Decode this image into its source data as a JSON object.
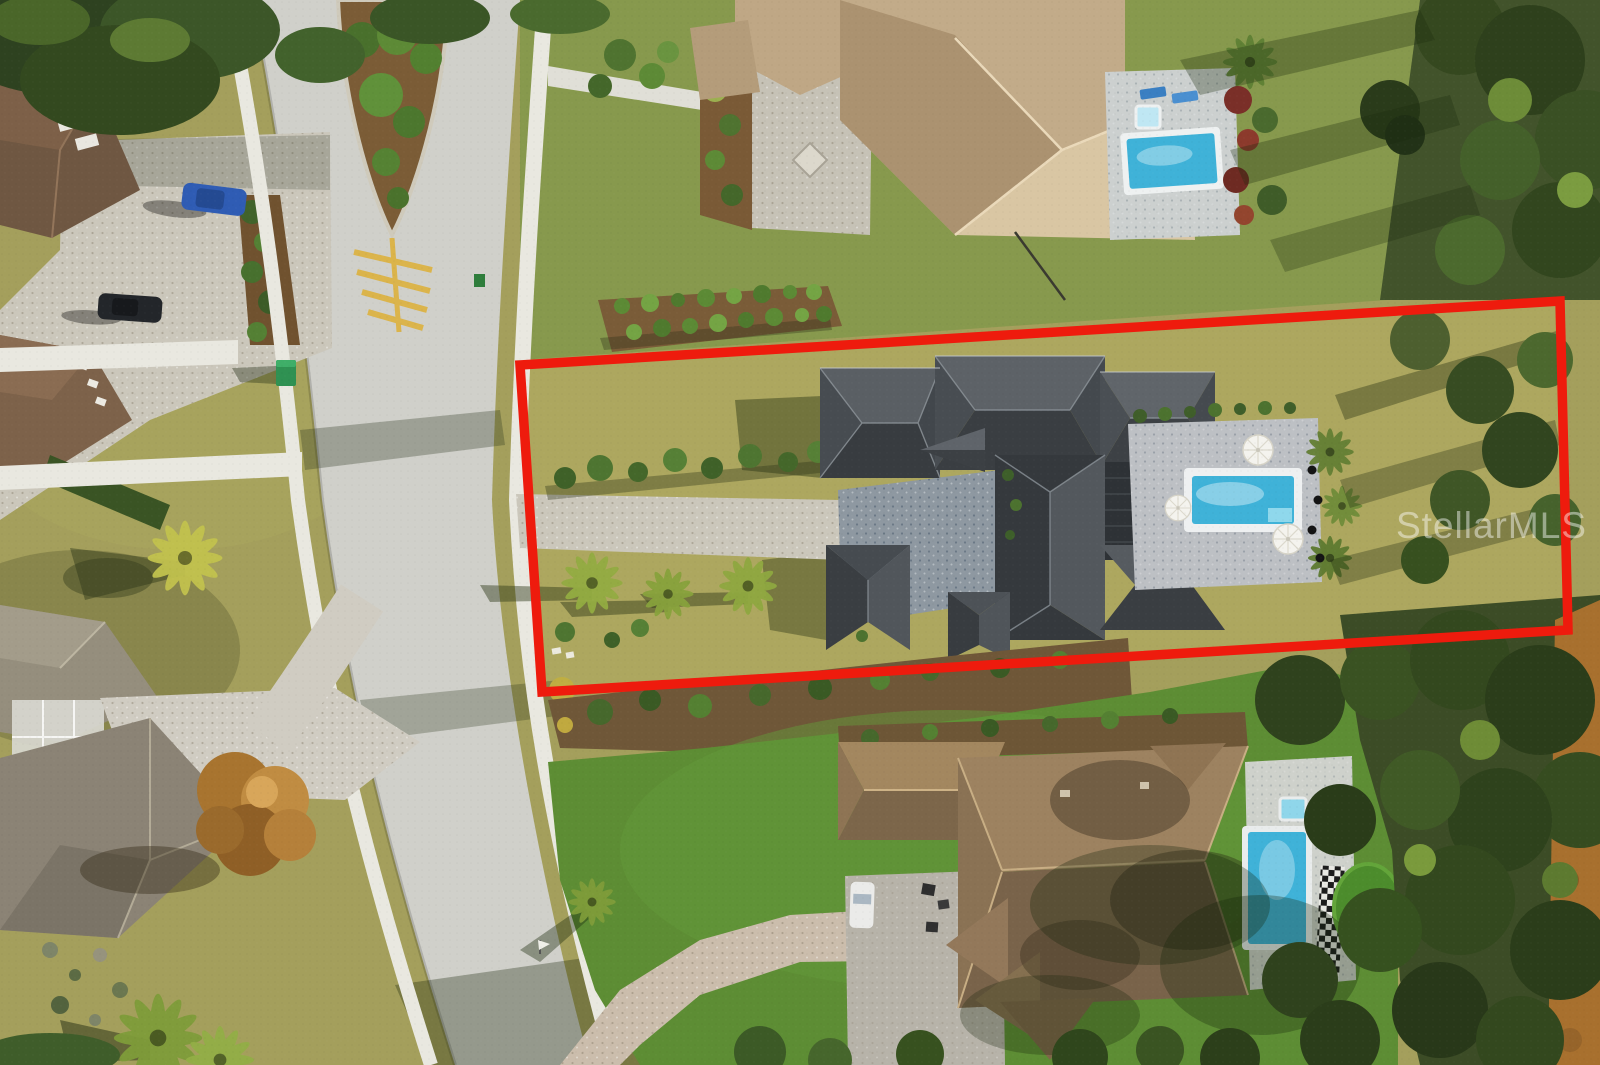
{
  "image": {
    "description": "Aerial drone photo of a residential neighborhood with the subject lot outlined in red",
    "watermark": {
      "text": "StellarMLS"
    }
  },
  "property_outline": {
    "color": "#ee1b0d",
    "points": "520,365 1560,301 1568,630 542,692"
  },
  "colors": {
    "lawn_olive": "#a49f5c",
    "north_lawn": "#87994d",
    "lot_lawn": "#ada75f",
    "turf_green": "#5d8d34",
    "road": "#d0d0ca",
    "sidewalk": "#e9e8e0",
    "paver_gray": "#cbc7bb",
    "court_slate": "#8e98a1",
    "pool_water": "#3fb2d8",
    "roof_charcoal": "#3c4044",
    "roof_tan": "#c2ab89",
    "roof_brown": "#8a7050",
    "woods_green": "#42532b",
    "mulch_brown": "#6f5738",
    "chevron_yellow": "#ddb13e",
    "dirt_orange": "#a8702e"
  }
}
